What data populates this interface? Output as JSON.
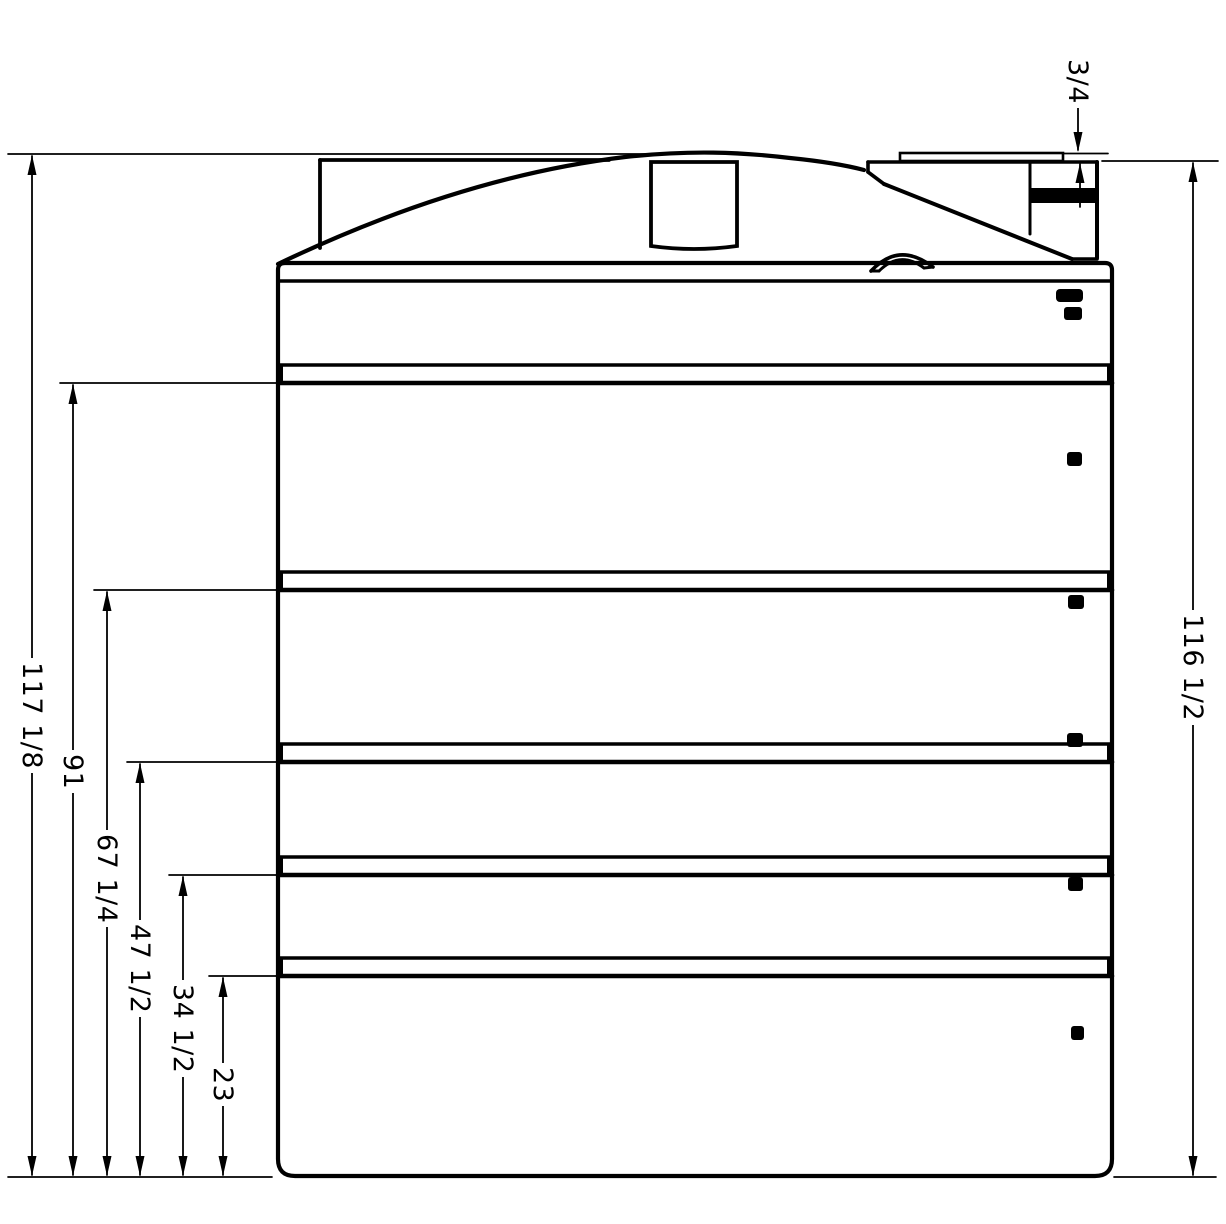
{
  "figure": {
    "type": "technical-drawing",
    "description": "Side elevation of a ribbed vertical storage tank with stacked height dimensions",
    "background_color": "#ffffff",
    "line_color": "#000000",
    "band_count": 6,
    "groove_count": 5,
    "side_fitting_count": 7
  },
  "dimensions": {
    "overall_height": {
      "label": "117 1/8"
    },
    "right_overall_height": {
      "label": "116 1/2"
    },
    "fitting_lip": {
      "label": "3/4"
    },
    "rib_heights": [
      {
        "label": "91"
      },
      {
        "label": "67 1/4"
      },
      {
        "label": "47 1/2"
      },
      {
        "label": "34 1/2"
      },
      {
        "label": "23"
      }
    ]
  }
}
